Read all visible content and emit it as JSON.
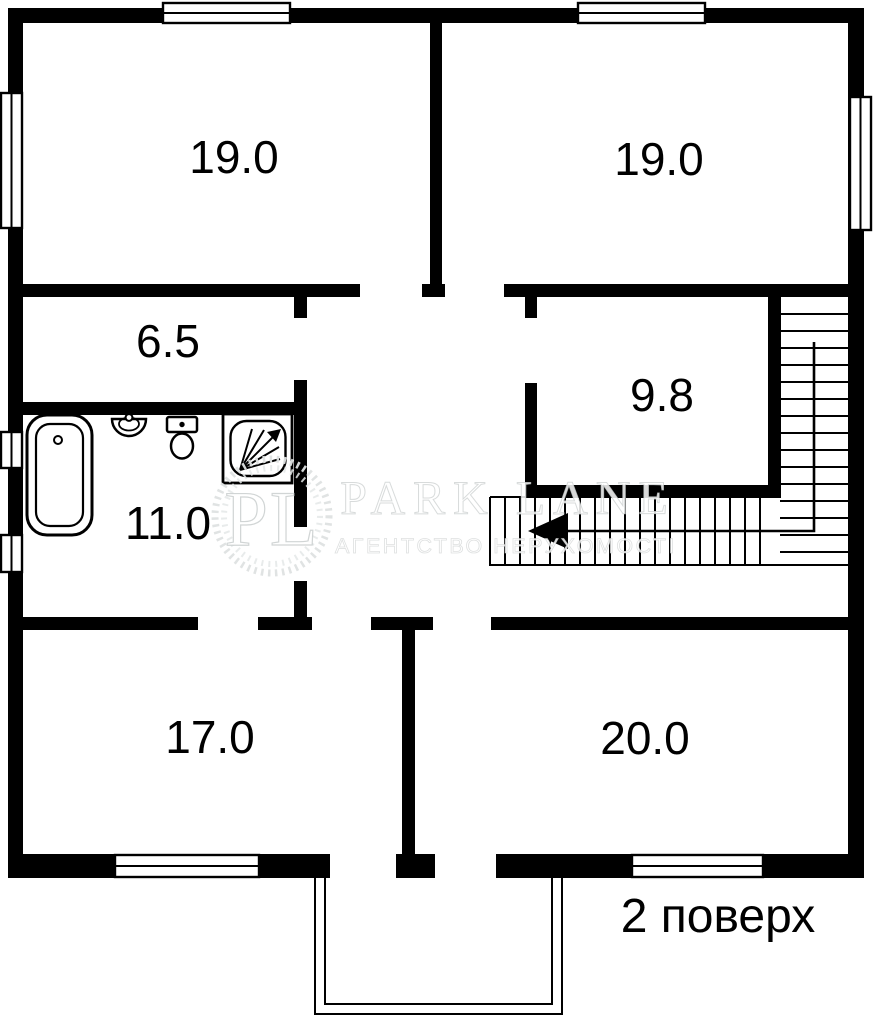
{
  "floor_plan": {
    "floor_label": "2 поверх",
    "rooms": [
      {
        "name": "bedroom-top-left",
        "area_sqm": "19.0"
      },
      {
        "name": "bedroom-top-right",
        "area_sqm": "19.0"
      },
      {
        "name": "hallway",
        "area_sqm": "6.5"
      },
      {
        "name": "room-mid-right",
        "area_sqm": "9.8"
      },
      {
        "name": "bathroom",
        "area_sqm": "11.0"
      },
      {
        "name": "room-bottom-left",
        "area_sqm": "17.0"
      },
      {
        "name": "room-bottom-right",
        "area_sqm": "20.0"
      }
    ],
    "fixtures": [
      "bathtub-icon",
      "sink-icon",
      "toilet-icon",
      "shower-icon"
    ],
    "stairs": {
      "direction_arrow": "left"
    },
    "colors": {
      "wall": "#000000",
      "background": "#ffffff",
      "watermark": "#e6e6e6"
    }
  },
  "watermark": {
    "monogram": "PL",
    "brand": "PARK LANE",
    "tagline": "АГЕНТСТВО НЕРУХОМОСТІ"
  }
}
